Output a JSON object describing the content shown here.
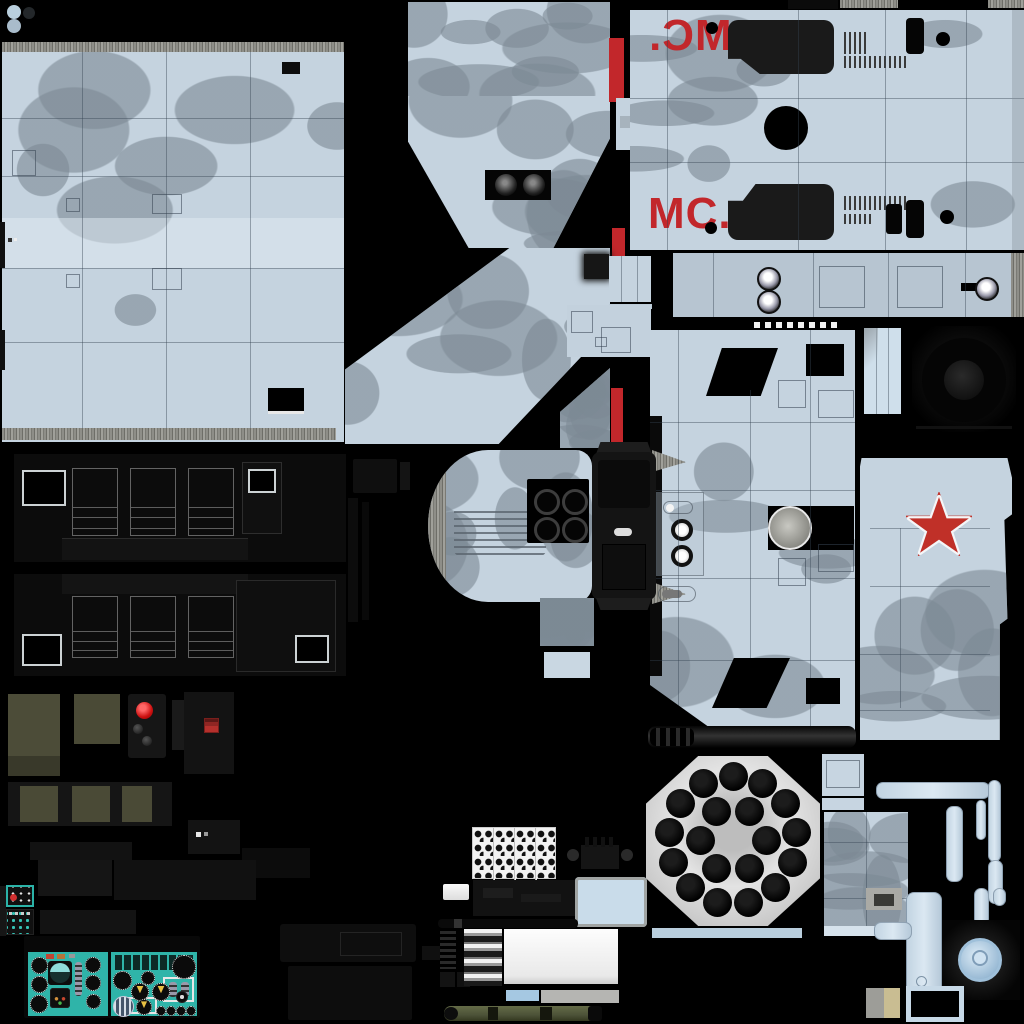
{
  "meta": {
    "description": "Winter-camouflage helicopter texture atlas sheet"
  },
  "markings": {
    "fuselage_code": "МС.",
    "code_color": "#c2272b",
    "star_color": "#c03028"
  },
  "palette": {
    "background": "#000000",
    "camo_base": "#c5d3df",
    "camo_blob": "rgba(124,137,148,0.6)",
    "panel_line": "rgba(52,66,80,0.42)",
    "cockpit_teal": "#2fb4a9",
    "ammo_olive": "#4c4c38",
    "warning_red": "#cc2b2b",
    "metal_dark": "#111111",
    "pod_plate": "#d6d6d6"
  },
  "rocket_pod": {
    "tube_total": 19,
    "outer_ring": 13,
    "inner_ring": 6,
    "outer_radius": 64,
    "inner_radius": 33,
    "tube_diameter": 29
  },
  "instruments": {
    "left_panel_gauges": [
      [
        3,
        5,
        15,
        "g"
      ],
      [
        3,
        24,
        15,
        "g"
      ],
      [
        2,
        43,
        16,
        "g"
      ],
      [
        20,
        9,
        24,
        "a"
      ],
      [
        22,
        36,
        20,
        "r"
      ],
      [
        47,
        10,
        7,
        "s"
      ],
      [
        57,
        5,
        14,
        "g"
      ],
      [
        57,
        23,
        14,
        "g"
      ],
      [
        58,
        42,
        13,
        "g"
      ]
    ],
    "right_panel_gauges": [
      [
        2,
        19,
        17,
        "g"
      ],
      [
        30,
        19,
        12,
        "g"
      ],
      [
        20,
        31,
        16,
        "w"
      ],
      [
        41,
        31,
        16,
        "w"
      ],
      [
        61,
        3,
        22,
        "g"
      ],
      [
        65,
        39,
        10,
        "k"
      ],
      [
        2,
        44,
        19,
        "b"
      ],
      [
        25,
        47,
        14,
        "w"
      ],
      [
        45,
        54,
        8,
        "g"
      ],
      [
        55,
        54,
        8,
        "g"
      ],
      [
        65,
        54,
        8,
        "g"
      ],
      [
        75,
        54,
        8,
        "g"
      ]
    ]
  }
}
